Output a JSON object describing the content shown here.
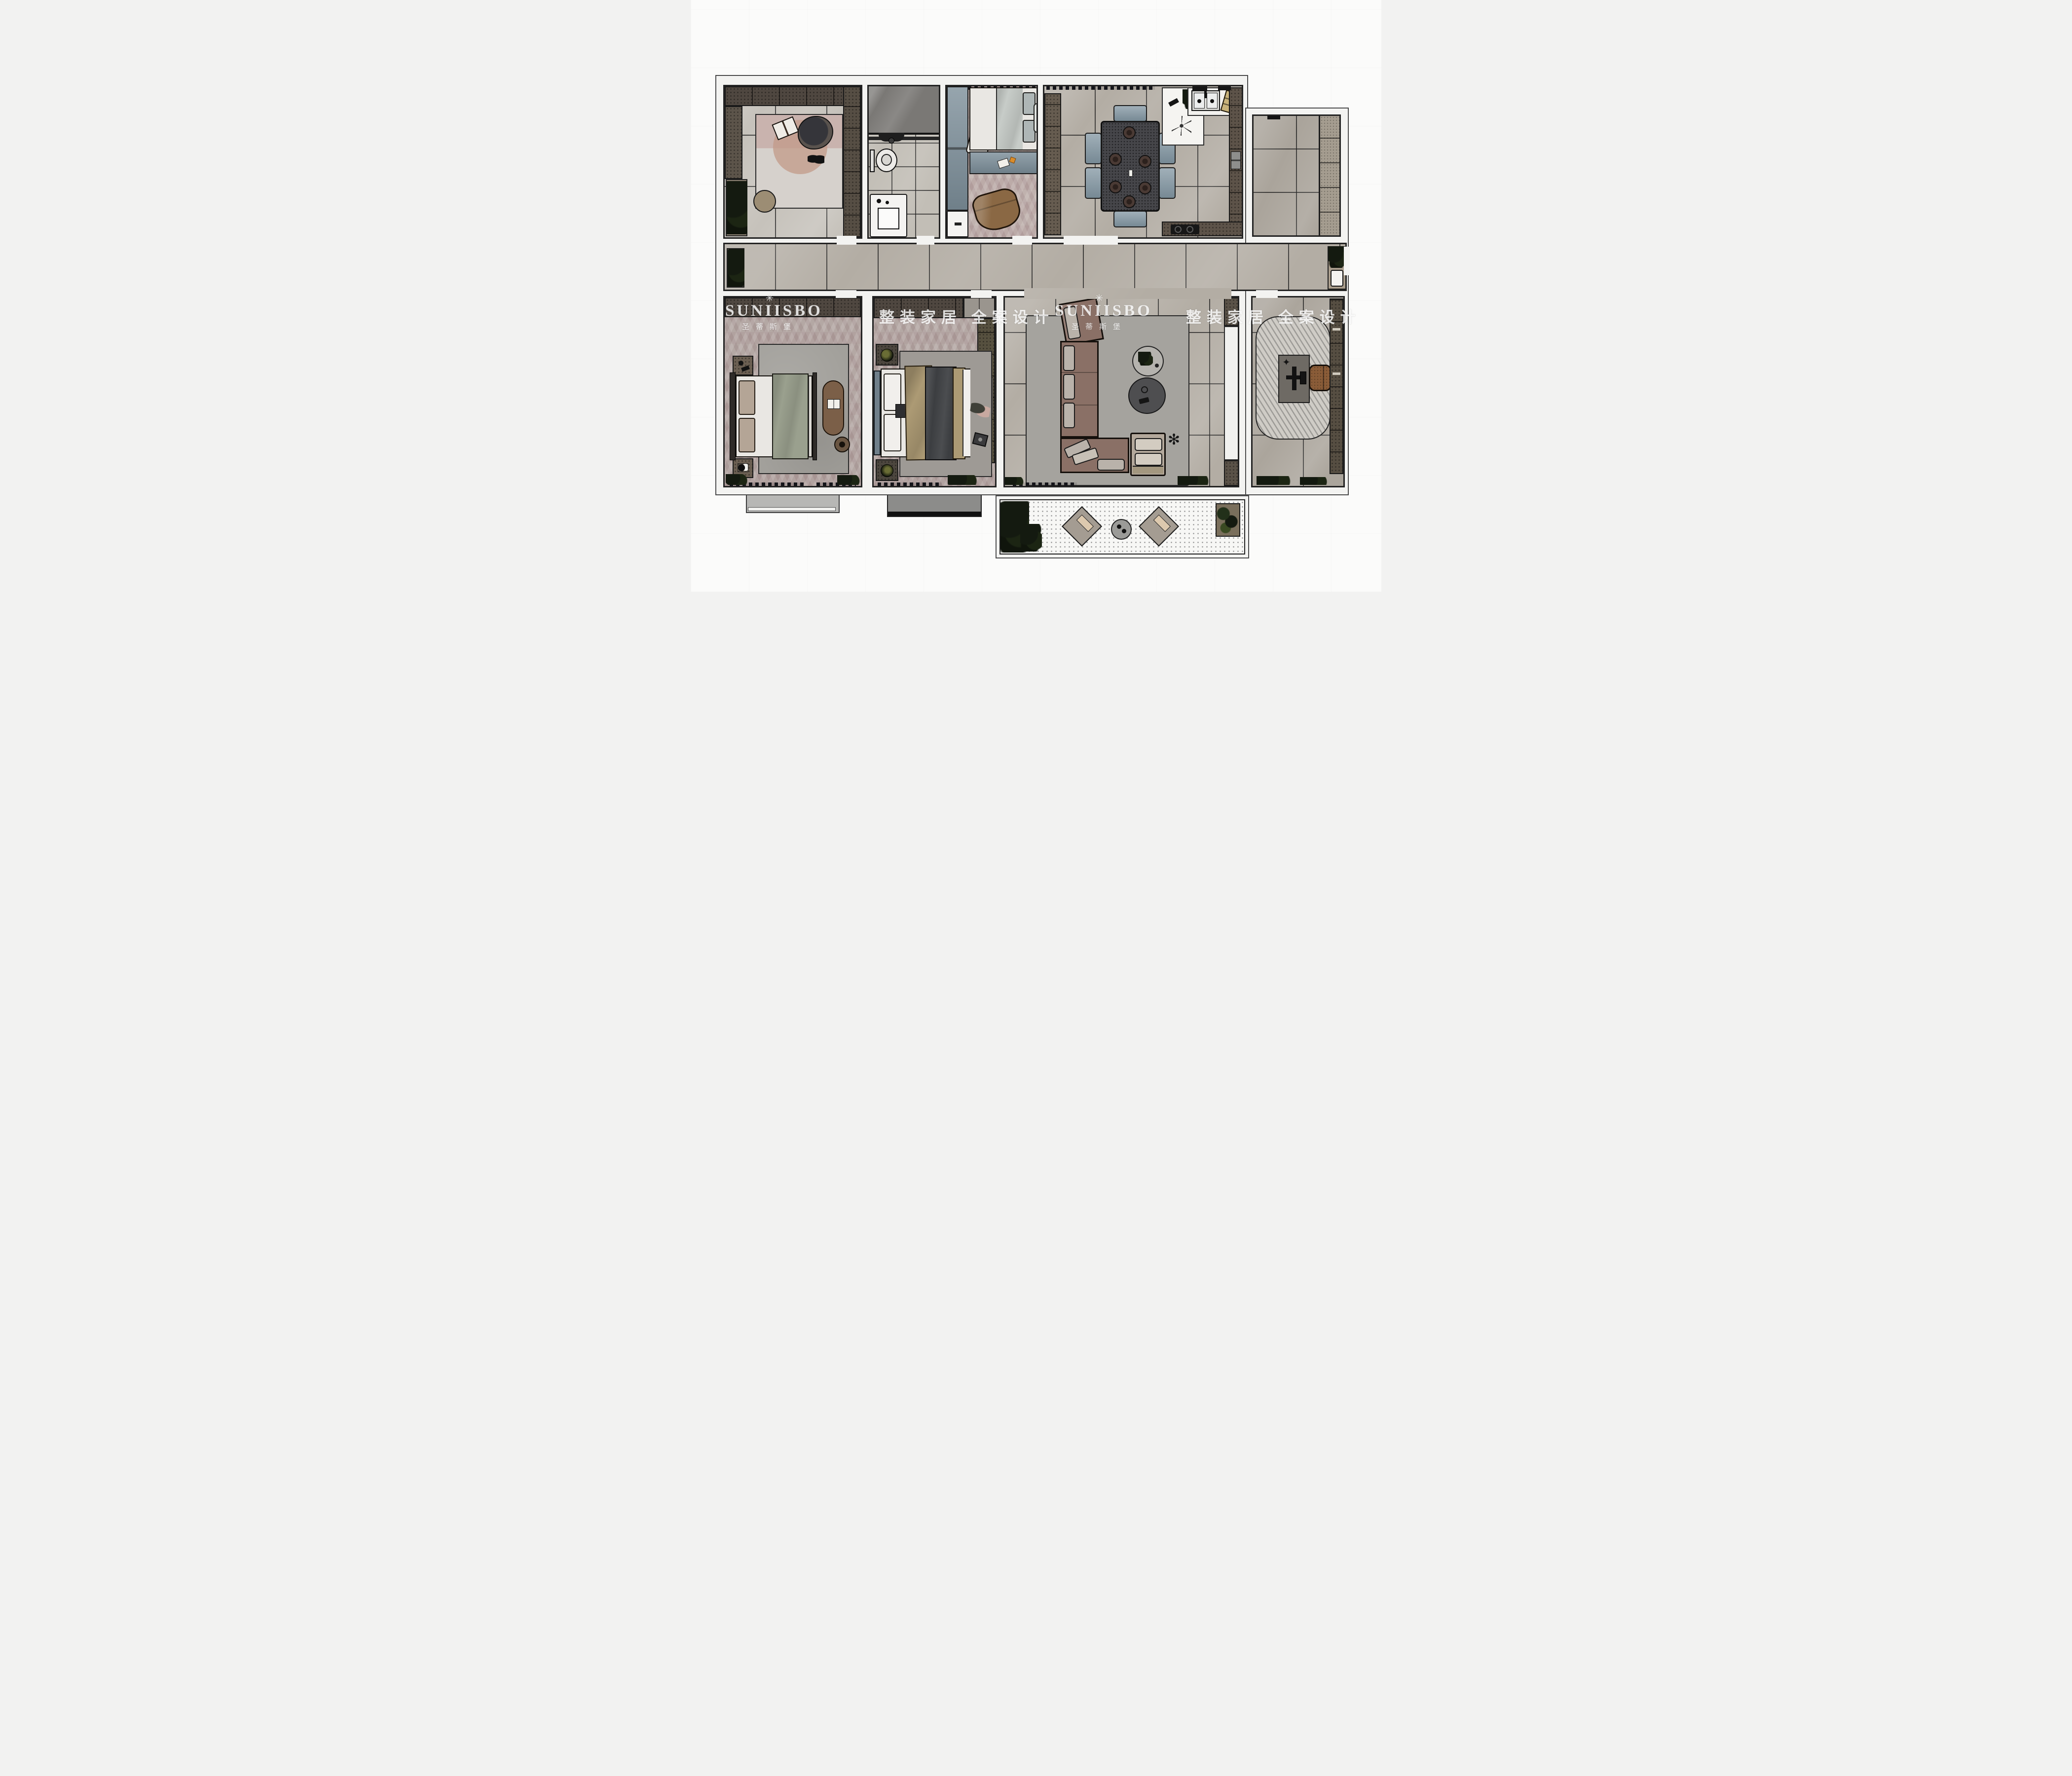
{
  "watermark": {
    "logo_glyph": "✳",
    "brand": "SUNIISBO",
    "brand_cn": "圣蒂斯堡",
    "tagline": "整装家居 全案设计"
  },
  "colors": {
    "canvas_bg": "#fbfbfa",
    "wall_fill": "#f3f3f1",
    "wall_line": "#2b2b2b",
    "tile": "#b3ada4",
    "tile_light": "#c2beb6",
    "tile_dark": "#7a7874",
    "hb": "#b4a8a4",
    "cab_dark": "#4f4740",
    "cab_brown": "#6b5f52",
    "blue_gray": "#7c8e99",
    "chair_blue": "#8195a1",
    "sofa_base": "#8a7066",
    "cushion": "#b9b2aa",
    "rug": "#a2a09b",
    "bedwhite": "#e9e7e3",
    "sage": "#9aa08e",
    "tan": "#ac9a74",
    "quilt": "#3c3e41",
    "wood": "#8a5c38",
    "plant": "#141a10",
    "balcony_dot": "#9a9a9a",
    "wm": "rgba(255,255,255,0.82)"
  },
  "rooms": [
    {
      "id": "cloakroom",
      "floor": "large-tile"
    },
    {
      "id": "bathroom",
      "floor": "small-tile"
    },
    {
      "id": "bedroom-small",
      "floor": "herringbone"
    },
    {
      "id": "dining-kitchen",
      "floor": "large-tile"
    },
    {
      "id": "utility-balcony-right",
      "floor": "mid-tile"
    },
    {
      "id": "corridor",
      "floor": "large-tile"
    },
    {
      "id": "master-bedroom",
      "floor": "herringbone"
    },
    {
      "id": "bedroom-second",
      "floor": "herringbone"
    },
    {
      "id": "living-room",
      "floor": "large-tile"
    },
    {
      "id": "study",
      "floor": "large-tile"
    },
    {
      "id": "balcony-bottom",
      "floor": "dotted"
    }
  ]
}
